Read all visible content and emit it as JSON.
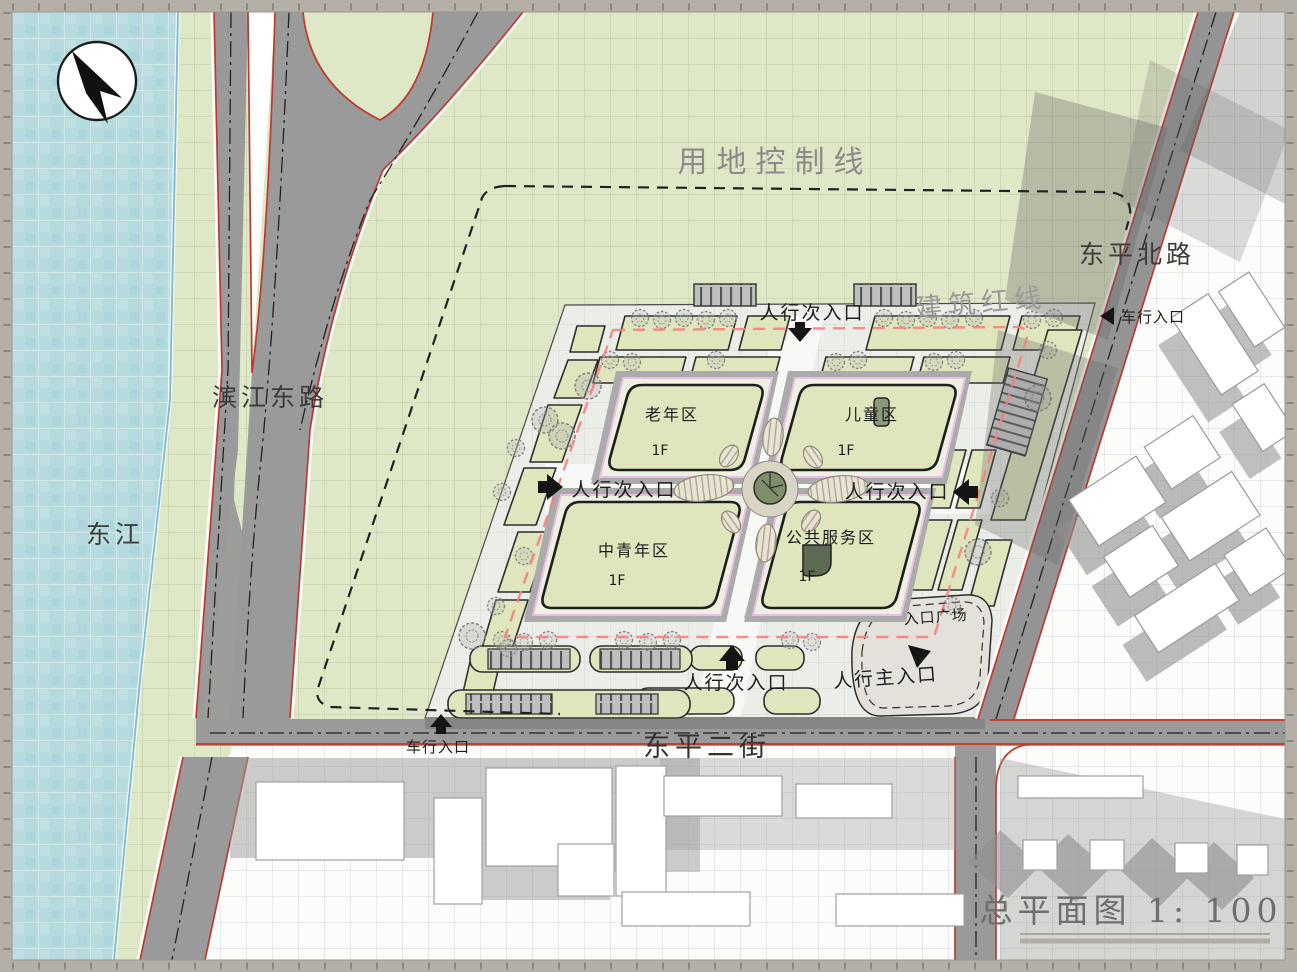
{
  "sheet": {
    "title": "总平面图 1: 1000"
  },
  "labels": {
    "land_use_control_line": "用地控制线",
    "building_red_line": "建筑红线",
    "river": "东江",
    "road_binjiang_east": "滨江东路",
    "road_dongping_north": "东平北路",
    "street_dongping_2nd": "东平二街",
    "entrance_plaza": "入口广场",
    "ped_main_entrance": "人行主入口",
    "ped_secondary_entrance": "人行次入口",
    "vehicle_entrance": "车行入口"
  },
  "zones": [
    {
      "name": "老年区",
      "floor": "1F"
    },
    {
      "name": "儿童区",
      "floor": "1F"
    },
    {
      "name": "中青年区",
      "floor": "1F"
    },
    {
      "name": "公共服务区",
      "floor": "1F"
    }
  ],
  "colors": {
    "water": "#b6dbdf",
    "greenfield": "#dfe8c6",
    "road_fill": "#9a9a9a",
    "site_paving": "#ebeee8",
    "zone_building_fill": "#dfe6bd",
    "road_red_edge": "#c0392b",
    "building_red_line_dash": "#f4827a",
    "control_line": "#222222",
    "canopy_gray": "#ababab",
    "shadow_gray": "#8b8b8b"
  }
}
